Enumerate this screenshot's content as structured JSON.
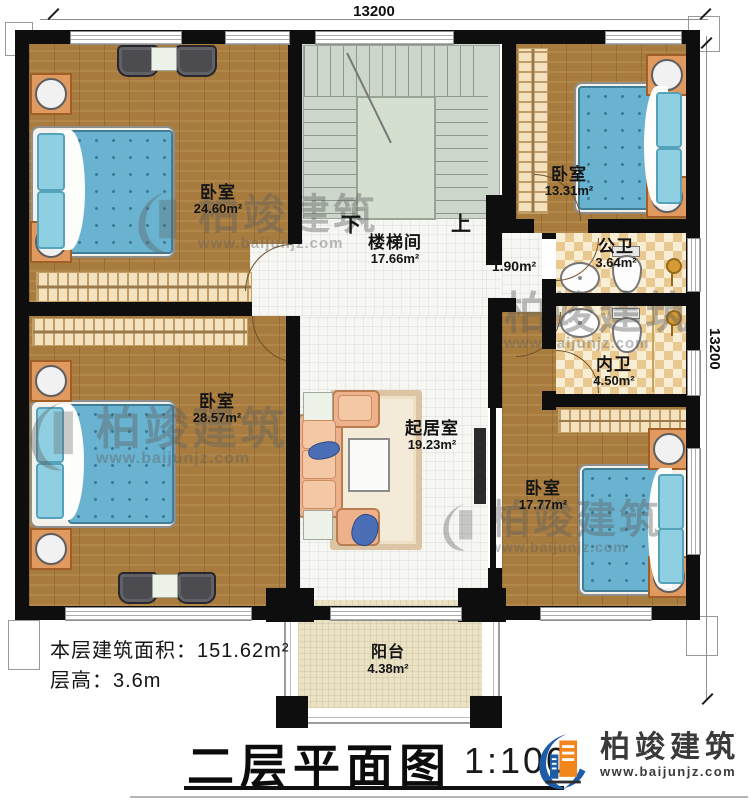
{
  "dimensions": {
    "top": "13200",
    "right": "13200"
  },
  "rooms": {
    "bedroom_tl": {
      "name": "卧室",
      "area": "24.60m²"
    },
    "bedroom_tr": {
      "name": "卧室",
      "area": "13.31m²"
    },
    "bedroom_bl": {
      "name": "卧室",
      "area": "28.57m²"
    },
    "bedroom_br": {
      "name": "卧室",
      "area": "17.77m²"
    },
    "stairwell": {
      "name": "楼梯间",
      "area": "17.66m²"
    },
    "hallway": {
      "area": "1.90m²"
    },
    "public_bath": {
      "name": "公卫",
      "area": "3.64m²"
    },
    "private_bath": {
      "name": "内卫",
      "area": "4.50m²"
    },
    "living": {
      "name": "起居室",
      "area": "19.23m²"
    },
    "balcony": {
      "name": "阳台",
      "area": "4.38m²"
    }
  },
  "stairs": {
    "down": "下",
    "up": "上"
  },
  "info": {
    "floor_area": "本层建筑面积：151.62m²",
    "floor_height": "层高：3.6m"
  },
  "title": {
    "text": "二层平面图",
    "scale": "1:100"
  },
  "logo": {
    "name": "柏竣建筑",
    "url": "www.baijunjz.com"
  },
  "watermark": {
    "name": "柏竣建筑",
    "url": "www.baijunjz.com"
  },
  "colors": {
    "wall": "#0e0e0e",
    "wood_floor": "#a87c3e",
    "stair_floor": "#ccd6ca",
    "bath_tile": "#e9c98f",
    "bed_blue": "#69b3d0",
    "logo_blue": "#1d5ca6",
    "logo_orange": "#f0861c"
  }
}
